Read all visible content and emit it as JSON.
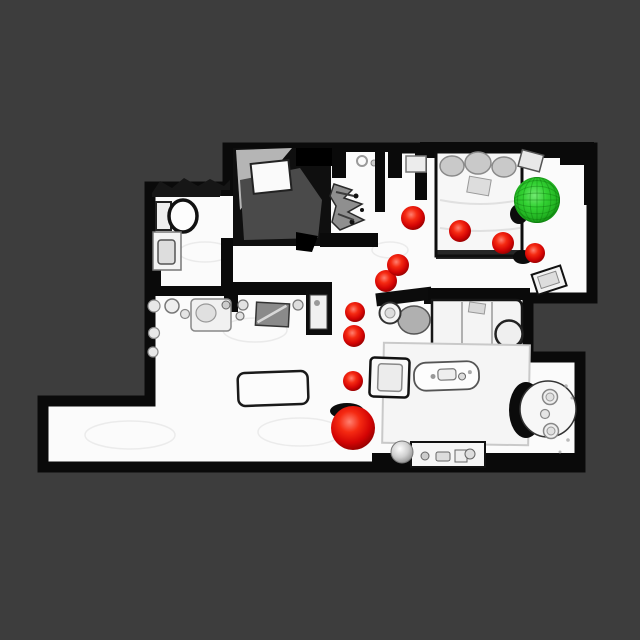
{
  "scene": {
    "type": "top-down-apartment-scan",
    "colors": {
      "background": "#3d3d3d",
      "floor": "#fbfbfb",
      "walls": "#0a0a0a",
      "waypoint_red": "#ee1010",
      "goal_green": "#2ecb2e"
    },
    "markers": {
      "agent_marker": {
        "x": 353,
        "y": 428,
        "r": 22,
        "shadow": {
          "cx": 347,
          "cy": 411,
          "rx": 17,
          "ry": 8
        }
      },
      "goal_marker": {
        "x": 537,
        "y": 200,
        "r": 23,
        "shadow": {
          "cx": 519,
          "cy": 214,
          "rx": 9,
          "ry": 10
        }
      },
      "waypoints": [
        {
          "x": 353,
          "y": 381,
          "r": 10
        },
        {
          "x": 354,
          "y": 336,
          "r": 11
        },
        {
          "x": 355,
          "y": 312,
          "r": 10
        },
        {
          "x": 386,
          "y": 281,
          "r": 11
        },
        {
          "x": 398,
          "y": 265,
          "r": 11
        },
        {
          "x": 413,
          "y": 218,
          "r": 12
        },
        {
          "x": 460,
          "y": 231,
          "r": 11
        },
        {
          "x": 503,
          "y": 243,
          "r": 11
        },
        {
          "x": 535,
          "y": 253,
          "r": 10,
          "shadow": {
            "cx": 523,
            "cy": 257,
            "rx": 10,
            "ry": 7
          }
        }
      ]
    }
  }
}
